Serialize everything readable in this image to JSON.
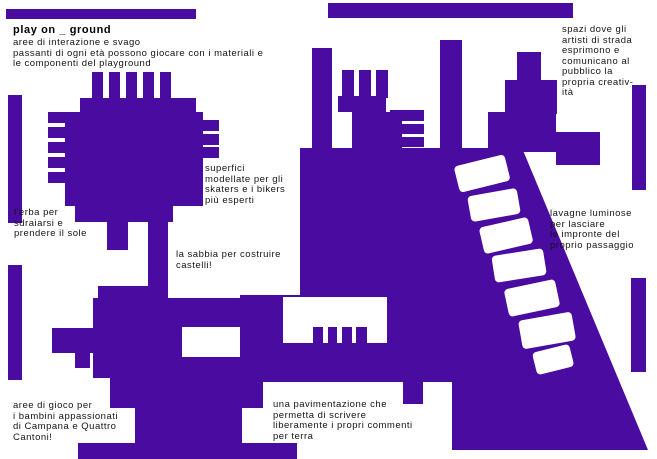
{
  "title": "play on _ ground",
  "colors": {
    "purple": "#4a0ba1",
    "background": "#ffffff",
    "text": "#141414"
  },
  "annotations": {
    "intro": {
      "text": "aree di interazione e svago\npassanti di ogni età possono giocare con i materiali e\nle componenti del playground"
    },
    "spazi": {
      "text": "spazi dove gli\nartisti di strada\nesprimono e\ncomunicano al\npubblico la\npropria creativ-\nità"
    },
    "erba": {
      "text": "l'erba per\nsdraiarsi e\nprendere il sole"
    },
    "superfici": {
      "text": "superfici\nmodellate per gli\nskaters e i bikers\npiù esperti"
    },
    "sabbia": {
      "text": "la sabbia per costruire\ncastelli!"
    },
    "lavagne": {
      "text": "lavagne luminose\nper lasciare\nle impronte del\nproprio passaggio"
    },
    "gioco": {
      "text": "aree di gioco per\ni bambini appassionati\ndi Campana e Quattro\nCantoni!"
    },
    "pavimentazione": {
      "text": "una pavimentazione che\npermetta di scrivere\nliberamente i propri commenti\nper terra"
    }
  }
}
